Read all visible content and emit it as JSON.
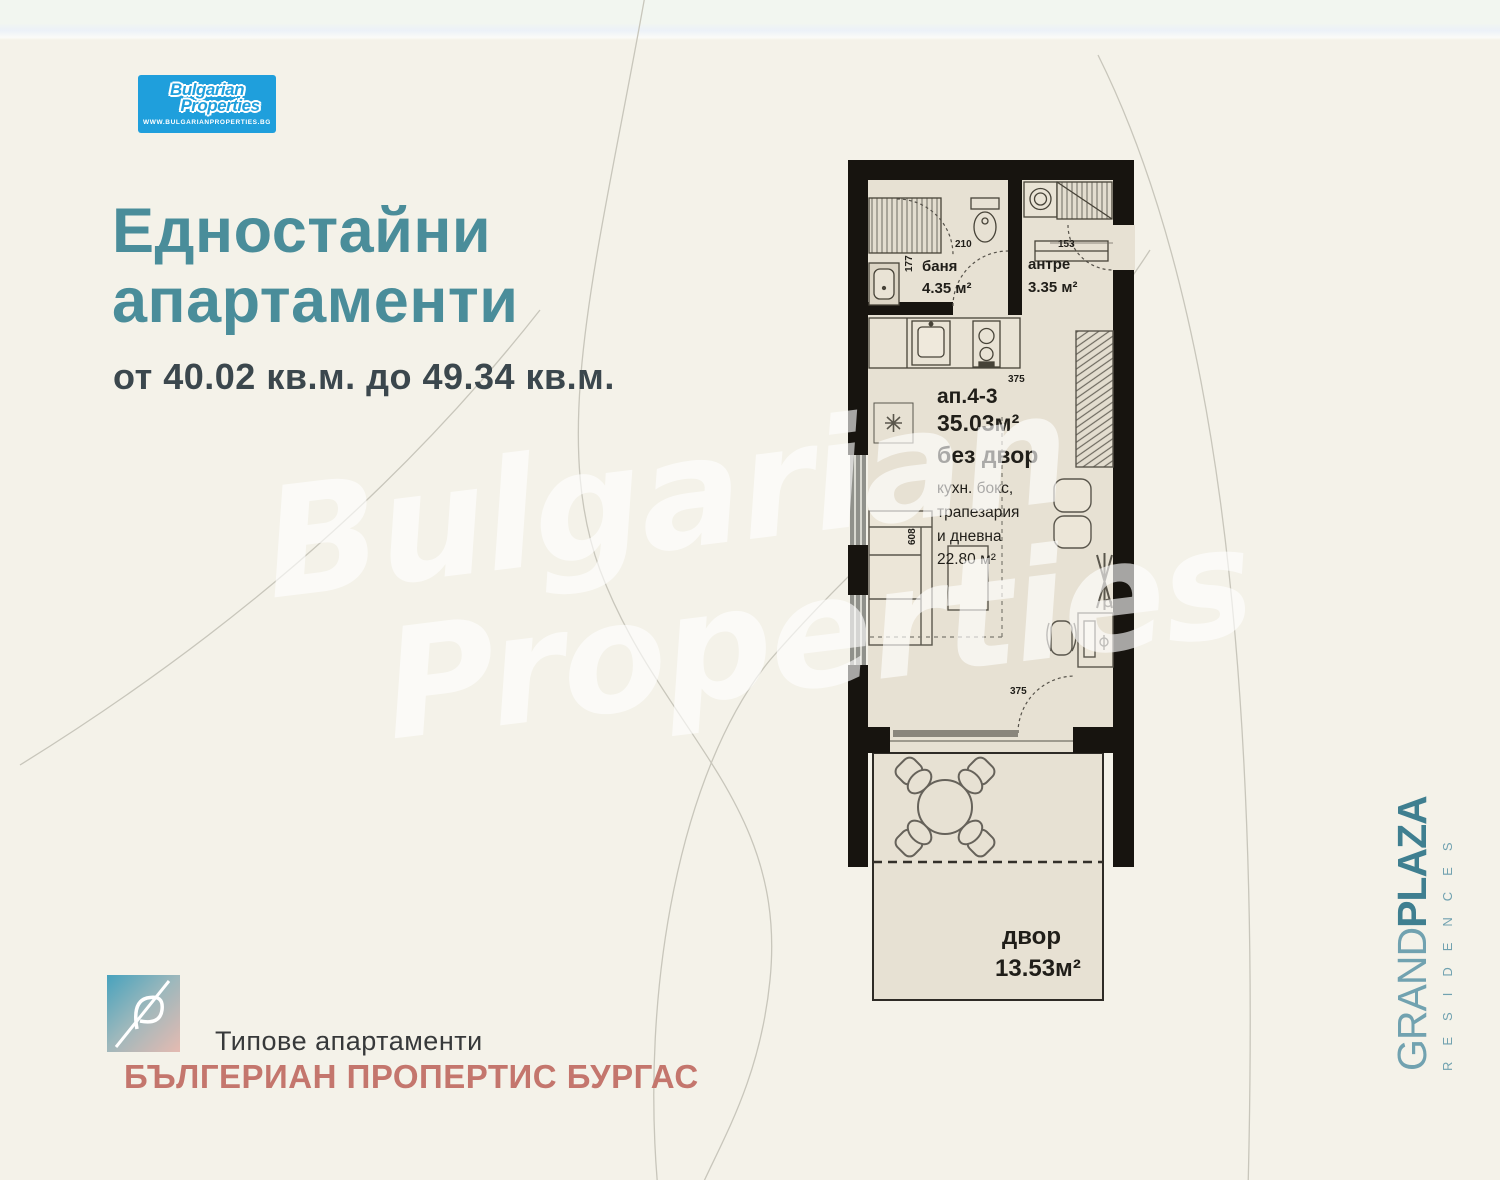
{
  "colors": {
    "teal": "#4a8d9a",
    "logo_blue": "#1f9fdc",
    "agency_red": "#c4766d",
    "wall_black": "#17140f",
    "floor_beige": "#e7e1d3"
  },
  "brand_logo": {
    "line1": "Bulgarian",
    "line2": "Properties",
    "website": "WWW.BULGARIANPROPERTIES.BG"
  },
  "header": {
    "title_line1": "Едностайни",
    "title_line2": "апартаменти",
    "subtitle": "от 40.02 кв.м. до 49.34 кв.м."
  },
  "plan": {
    "bathroom": {
      "name": "баня",
      "area": "4.35 м²"
    },
    "entrance": {
      "name": "антре",
      "area": "3.35 м²"
    },
    "apartment": {
      "label": "ап.4-3",
      "area": "35.03м²",
      "note": "без двор"
    },
    "living": {
      "line1": "кухн. бокс,",
      "line2": "трапезария",
      "line3": "и дневна",
      "area": "22.80 м²"
    },
    "yard": {
      "name": "двор",
      "area": "13.53м²"
    },
    "dims": {
      "toilet": "210",
      "hall": "153",
      "shower": "177",
      "kitchen": "375",
      "room_h": "608",
      "room_w": "375"
    }
  },
  "watermark": {
    "line1": "Bulgarian",
    "line2": "Properties"
  },
  "side_brand": {
    "grand": "GRAND",
    "plaza": "PLAZA",
    "sub": "RESIDENCES"
  },
  "footer": {
    "caption": "Типове апартаменти",
    "agency": "БЪЛГЕРИАН ПРОПЕРТИС БУРГАС"
  }
}
